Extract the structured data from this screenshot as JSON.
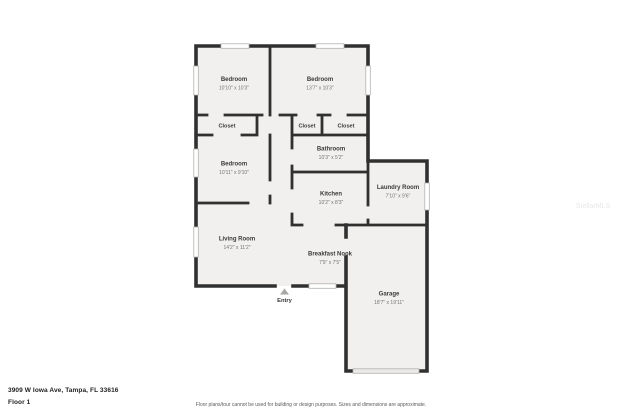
{
  "address": "3909 W Iowa Ave, Tampa, FL 33616",
  "floor_label": "Floor 1",
  "disclaimer": "Floor plans/tour cannot be used for building or design purposes. Sizes and dimensions are approximate.",
  "watermark": "StellarMLS",
  "entry": {
    "label": "Entry"
  },
  "colors": {
    "wall": "#303030",
    "room_fill": "#f1f0ee",
    "room_name_text": "#3a3a3a",
    "room_dims_text": "#767472",
    "window_stroke": "#b3b1ae",
    "garage_door_fill": "#ebe9e7"
  },
  "rooms": [
    {
      "id": "bedroom-top-left",
      "name": "Bedroom",
      "dims": "10'10\" x 10'3\""
    },
    {
      "id": "bedroom-top-right",
      "name": "Bedroom",
      "dims": "13'7\" x 10'3\""
    },
    {
      "id": "closet-left",
      "name": "Closet",
      "dims": ""
    },
    {
      "id": "closet-middle",
      "name": "Closet",
      "dims": ""
    },
    {
      "id": "closet-right",
      "name": "Closet",
      "dims": ""
    },
    {
      "id": "bathroom",
      "name": "Bathroom",
      "dims": "10'3\" x 5'2\""
    },
    {
      "id": "bedroom-middle-left",
      "name": "Bedroom",
      "dims": "10'11\" x 9'10\""
    },
    {
      "id": "kitchen",
      "name": "Kitchen",
      "dims": "10'2\" x 8'3\""
    },
    {
      "id": "laundry-room",
      "name": "Laundry Room",
      "dims": "7'10\" x 9'6\""
    },
    {
      "id": "living-room",
      "name": "Living Room",
      "dims": "14'2\" x 11'2\""
    },
    {
      "id": "breakfast-nook",
      "name": "Breakfast Nook",
      "dims": "7'9\" x 7'5\""
    },
    {
      "id": "garage",
      "name": "Garage",
      "dims": "18'7\" x 19'11\""
    }
  ]
}
